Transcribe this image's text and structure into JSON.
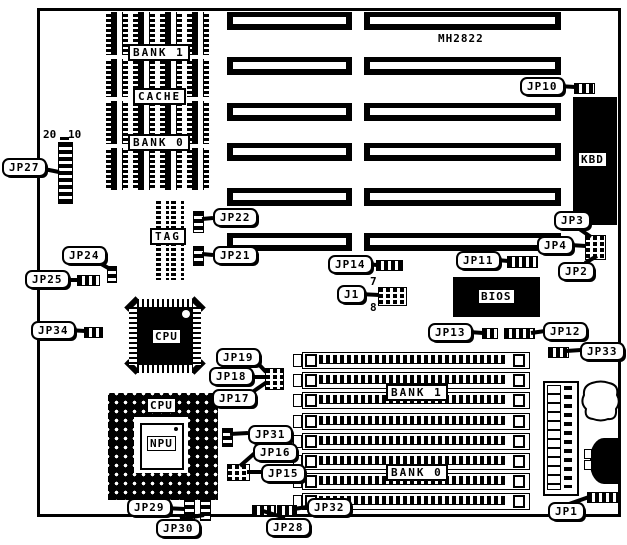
{
  "board": {
    "model": "MH2822"
  },
  "chips": {
    "dip_bank1": "BANK 1",
    "cache": "CACHE",
    "dip_bank0": "BANK 0",
    "tag": "TAG",
    "cpu_qfp": "CPU",
    "cpu_pga": "CPU",
    "npu": "NPU",
    "bios": "BIOS",
    "kbd": "KBD",
    "simm_bank1": "BANK 1",
    "simm_bank0": "BANK 0"
  },
  "callouts": {
    "jp1": "JP1",
    "jp2": "JP2",
    "jp3": "JP3",
    "jp4": "JP4",
    "jp10": "JP10",
    "jp11": "JP11",
    "jp12": "JP12",
    "jp13": "JP13",
    "jp14": "JP14",
    "jp15": "JP15",
    "jp16": "JP16",
    "jp17": "JP17",
    "jp18": "JP18",
    "jp19": "JP19",
    "jp21": "JP21",
    "jp22": "JP22",
    "jp24": "JP24",
    "jp25": "JP25",
    "jp27": "JP27",
    "jp28": "JP28",
    "jp29": "JP29",
    "jp30": "JP30",
    "jp31": "JP31",
    "jp32": "JP32",
    "jp33": "JP33",
    "jp34": "JP34",
    "j1": "J1"
  },
  "pin_labels": {
    "jp27_pin20": "20",
    "jp27_pin10": "10",
    "j1_pin7": "7",
    "j1_pin8": "8"
  }
}
